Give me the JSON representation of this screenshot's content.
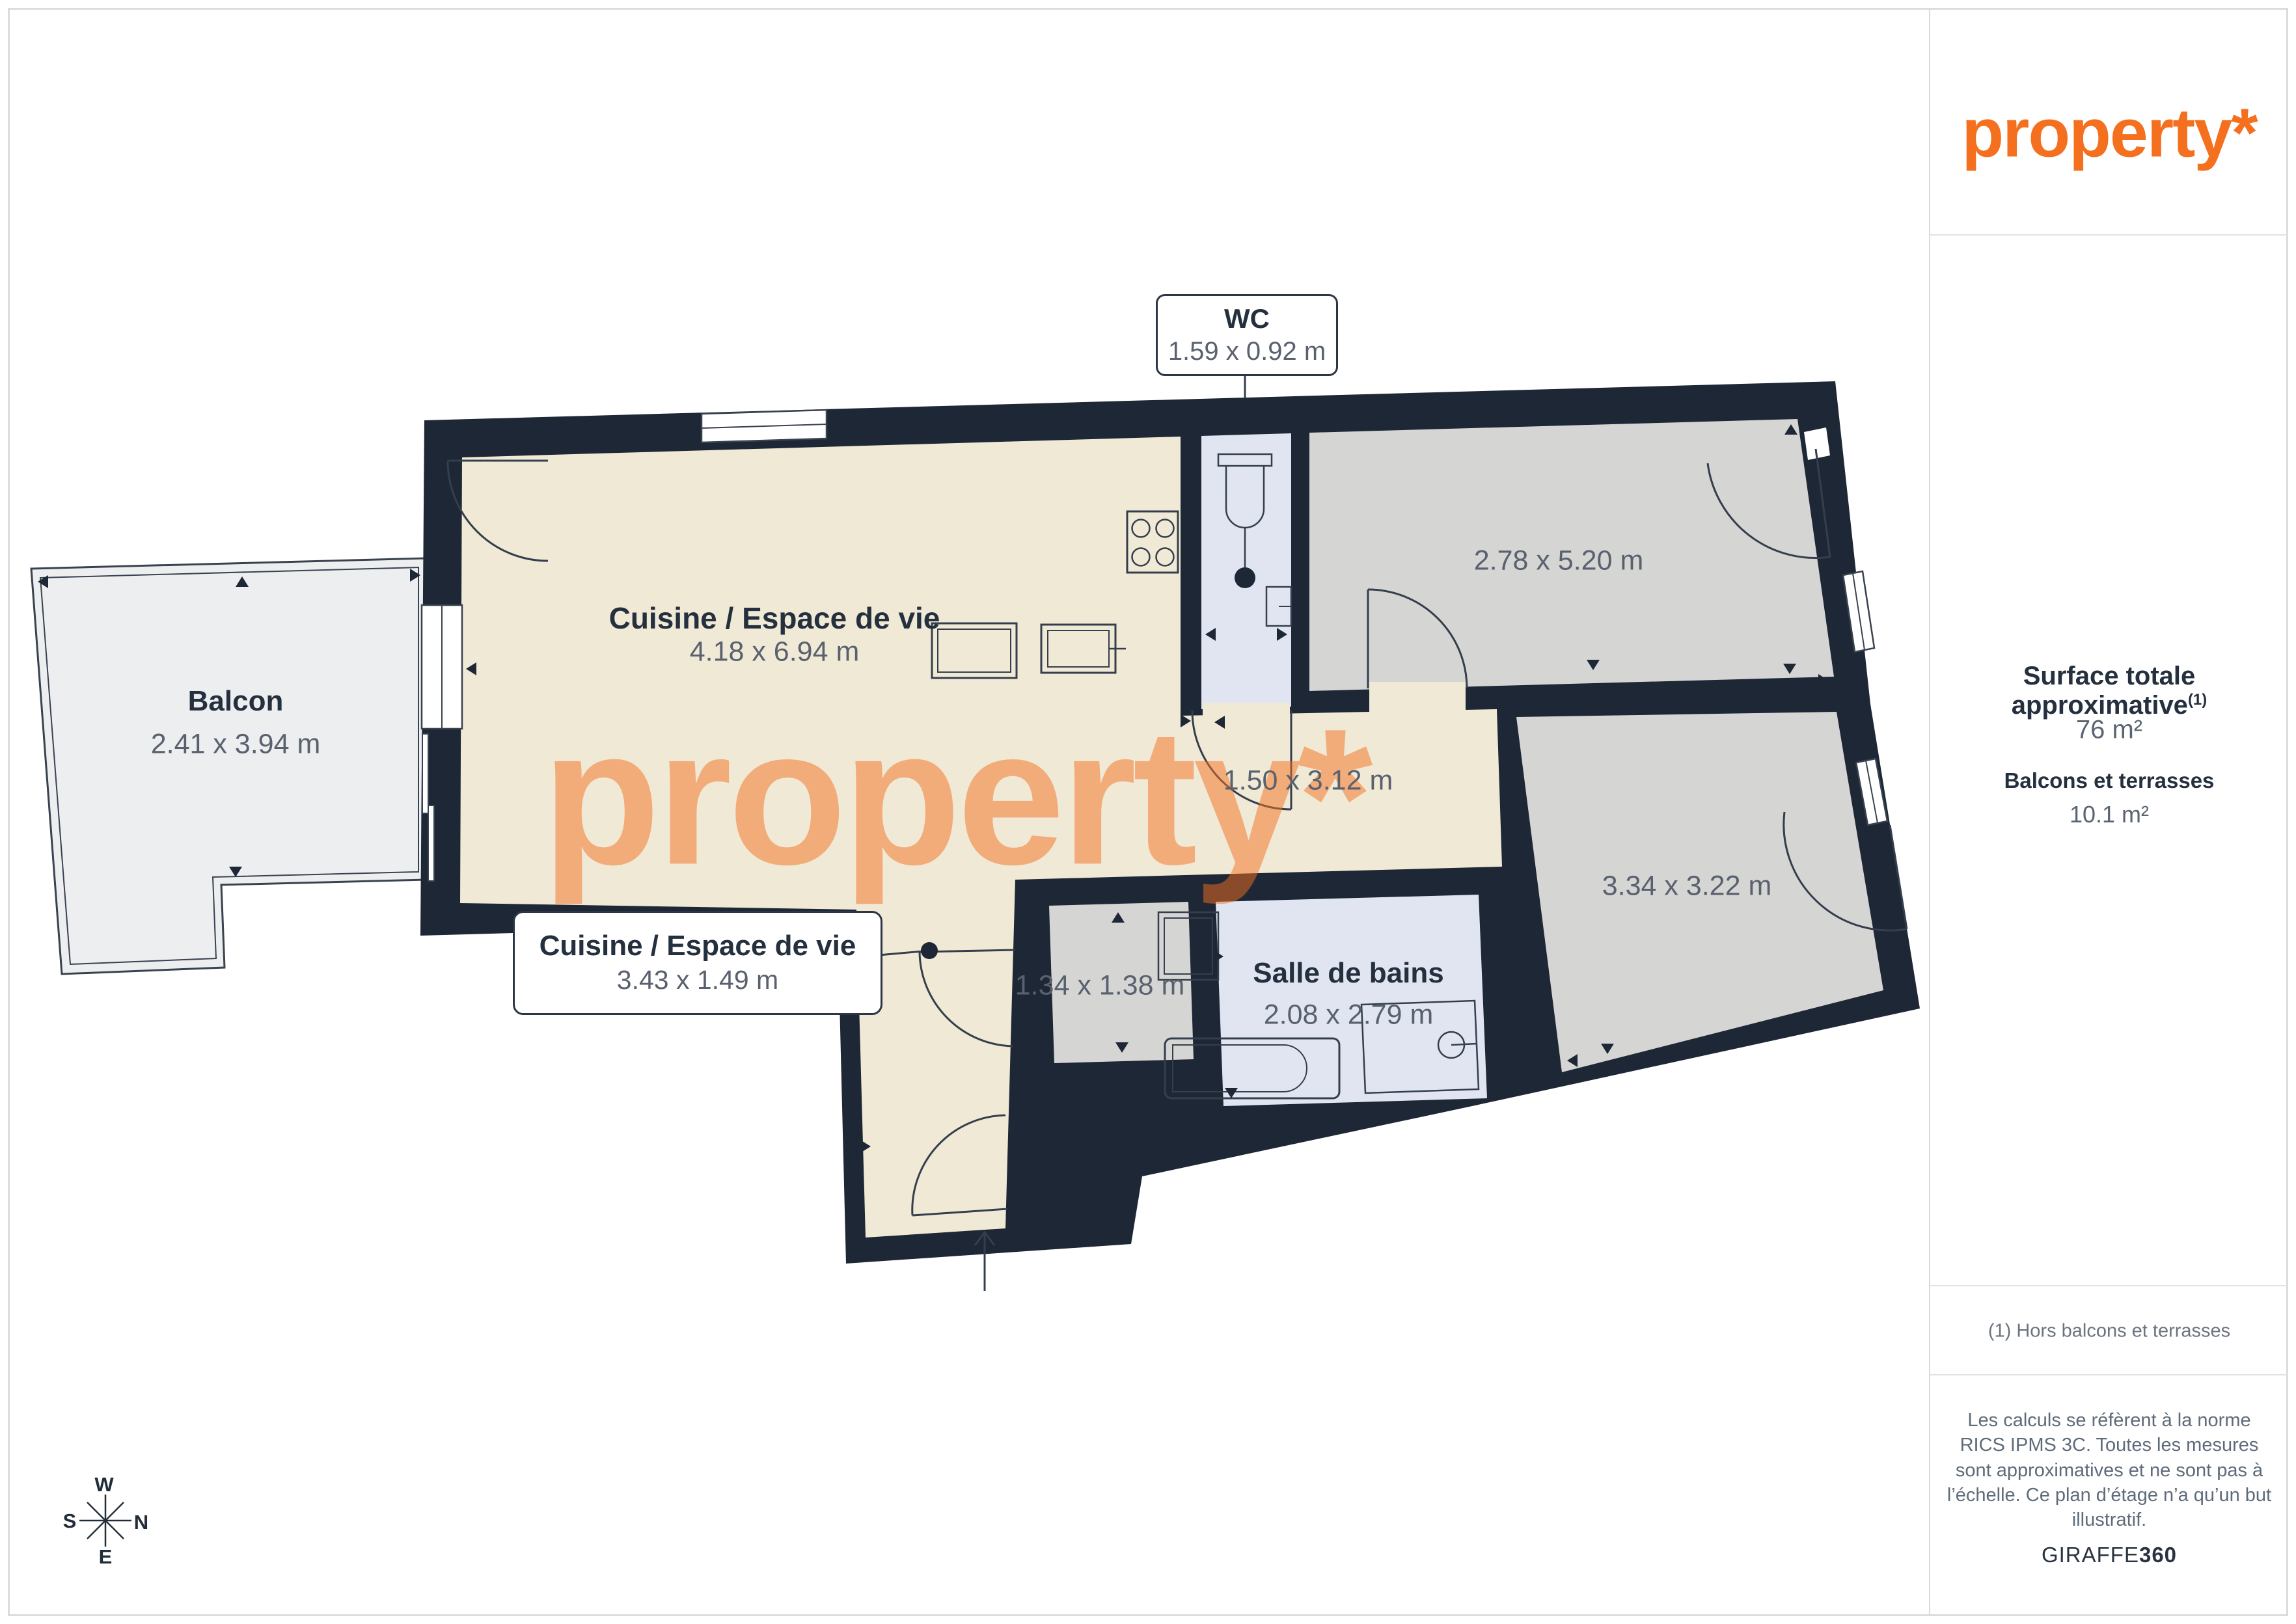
{
  "brand": {
    "logo": "property*",
    "watermark": "property*"
  },
  "sidebar": {
    "surface_title": "Surface totale approximative",
    "surface_sup": "(1)",
    "surface_value": "76 m²",
    "balconies_title": "Balcons et terrasses",
    "balconies_value": "10.1 m²",
    "footnote": "(1) Hors balcons et terrasses",
    "disclaimer": "Les calculs se réfèrent à la norme RICS IPMS 3C. Toutes les mesures sont approximatives et ne sont pas à l’échelle. Ce plan d’étage n’a qu’un but illustratif.",
    "brand_regular": "GIRAFFE",
    "brand_bold": "360"
  },
  "plan": {
    "labels": {
      "wc": {
        "name": "WC",
        "dims": "1.59 x 0.92 m"
      },
      "living": {
        "name": "Cuisine / Espace de vie",
        "dims": "4.18 x 6.94 m"
      },
      "kitchen_callout": {
        "name": "Cuisine / Espace de vie",
        "dims": "3.43 x 1.49 m"
      },
      "balcony": {
        "name": "Balcon",
        "dims": "2.41 x 3.94 m"
      },
      "hallway": {
        "dims": "1.50 x 3.12 m"
      },
      "closet": {
        "dims": "1.34 x 1.38 m"
      },
      "bathroom": {
        "name": "Salle de bains",
        "dims": "2.08 x 2.79 m"
      },
      "bedroom_top": {
        "dims": "2.78 x 5.20 m"
      },
      "bedroom_right": {
        "dims": "3.34 x 3.22 m"
      }
    }
  },
  "compass": {
    "n": "N",
    "s": "S",
    "e": "E",
    "w": "W"
  },
  "colors": {
    "wall": "#1d2735",
    "floor_living": "#f0e9d6",
    "floor_room": "#d5d5d4",
    "floor_wet": "#e0e5f1",
    "floor_balcony": "#eceef0",
    "accent_orange": "#f4701f",
    "text_dark": "#25303e",
    "text_dim": "#59616e"
  }
}
